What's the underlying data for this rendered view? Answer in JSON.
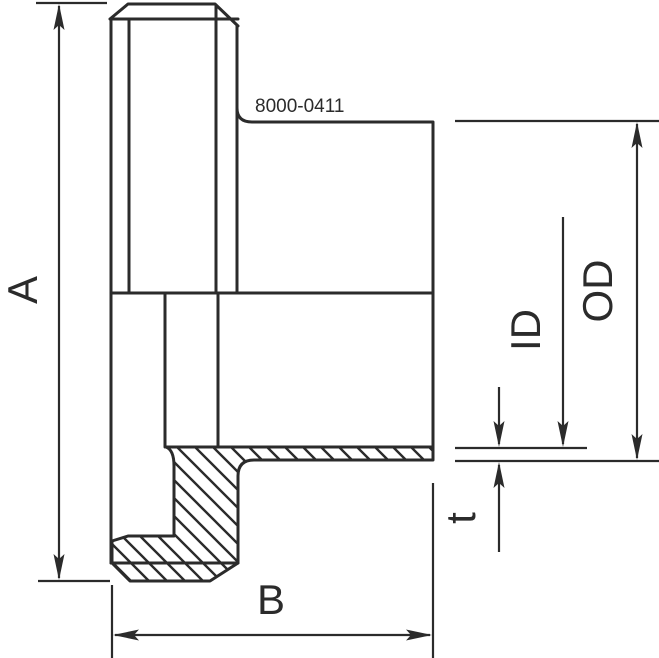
{
  "drawing": {
    "part_number": "8000-0411",
    "labels": {
      "height": "A",
      "width": "B",
      "inner_diameter": "ID",
      "outer_diameter": "OD",
      "thickness": "t"
    }
  },
  "colors": {
    "line": "#2b2b2b",
    "background": "#ffffff"
  }
}
